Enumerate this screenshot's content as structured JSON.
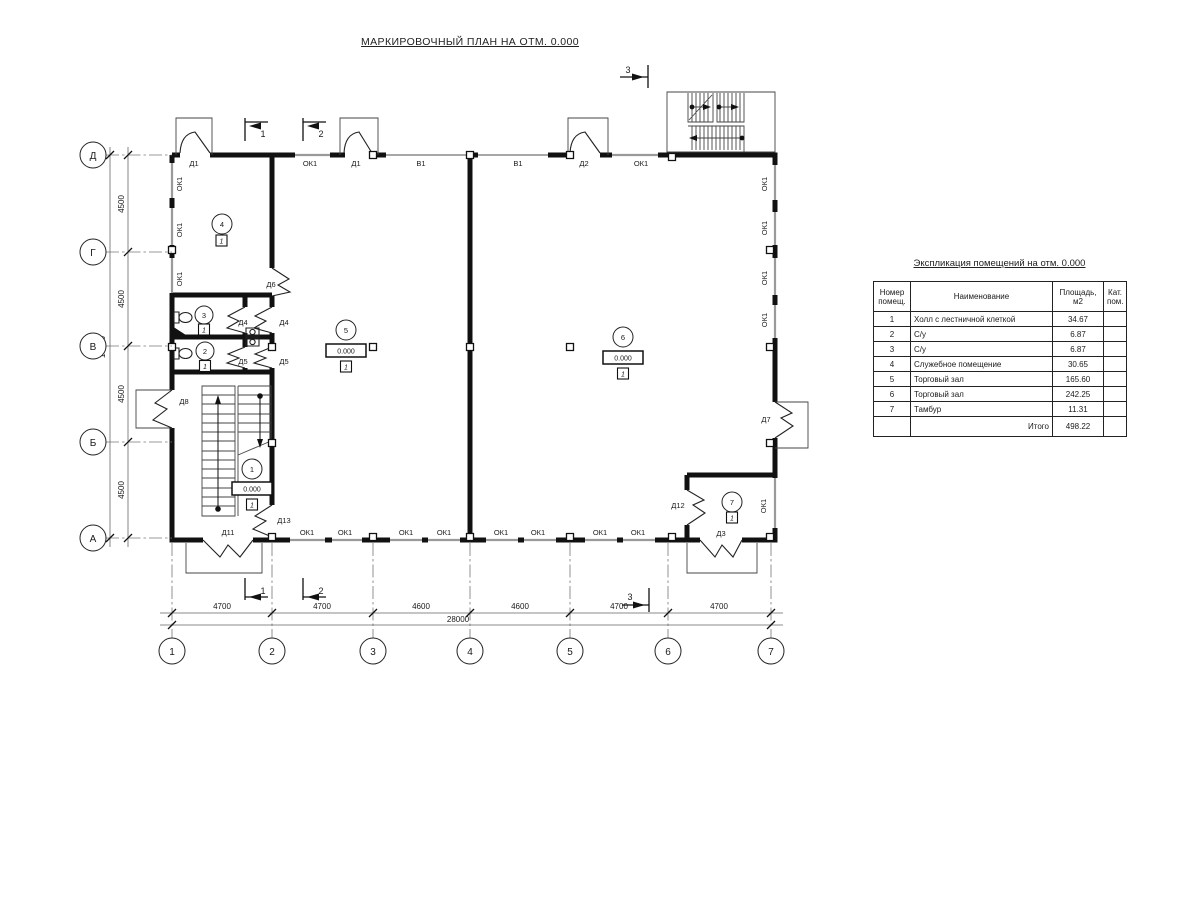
{
  "title": "МАРКИРОВОЧНЫЙ ПЛАН НА ОТМ. 0.000",
  "plan": {
    "level_mark": "0.000",
    "floor_type": "1",
    "labels": {
      "ok1": "ОК1",
      "v1": "В1",
      "d1": "Д1",
      "d2": "Д2",
      "d3": "Д3",
      "d4": "Д4",
      "d5": "Д5",
      "d6": "Д6",
      "d7": "Д7",
      "d8": "Д8",
      "d11": "Д11",
      "d12": "Д12",
      "d13": "Д13"
    },
    "rooms": [
      "1",
      "2",
      "3",
      "4",
      "5",
      "6",
      "7"
    ],
    "axes": {
      "cols": [
        "1",
        "2",
        "3",
        "4",
        "5",
        "6",
        "7"
      ],
      "rows": [
        "Д",
        "Г",
        "В",
        "Б",
        "А"
      ]
    },
    "dims": {
      "v4500": "4500",
      "v4700": "4700",
      "v4600": "4600",
      "v18000": "18000",
      "v28000": "28000"
    },
    "sections": {
      "s1": "1",
      "s2": "2",
      "s3": "3"
    }
  },
  "table": {
    "title": "Экспликация помещений на отм. 0.000",
    "headers": {
      "num": "Номер\nпомещ.",
      "name": "Наименование",
      "area": "Площадь,   м2",
      "cat": "Кат.\nпом."
    },
    "rows": [
      {
        "num": "1",
        "name": "Холл с лестничной клеткой",
        "area": "34.67",
        "cat": ""
      },
      {
        "num": "2",
        "name": "С/у",
        "area": "6.87",
        "cat": ""
      },
      {
        "num": "3",
        "name": "С/у",
        "area": "6.87",
        "cat": ""
      },
      {
        "num": "4",
        "name": "Служебное помещение",
        "area": "30.65",
        "cat": ""
      },
      {
        "num": "5",
        "name": "Торговый зал",
        "area": "165.60",
        "cat": ""
      },
      {
        "num": "6",
        "name": "Торговый зал",
        "area": "242.25",
        "cat": ""
      },
      {
        "num": "7",
        "name": "Тамбур",
        "area": "11.31",
        "cat": ""
      }
    ],
    "total_label": "Итого",
    "total": "498.22"
  }
}
